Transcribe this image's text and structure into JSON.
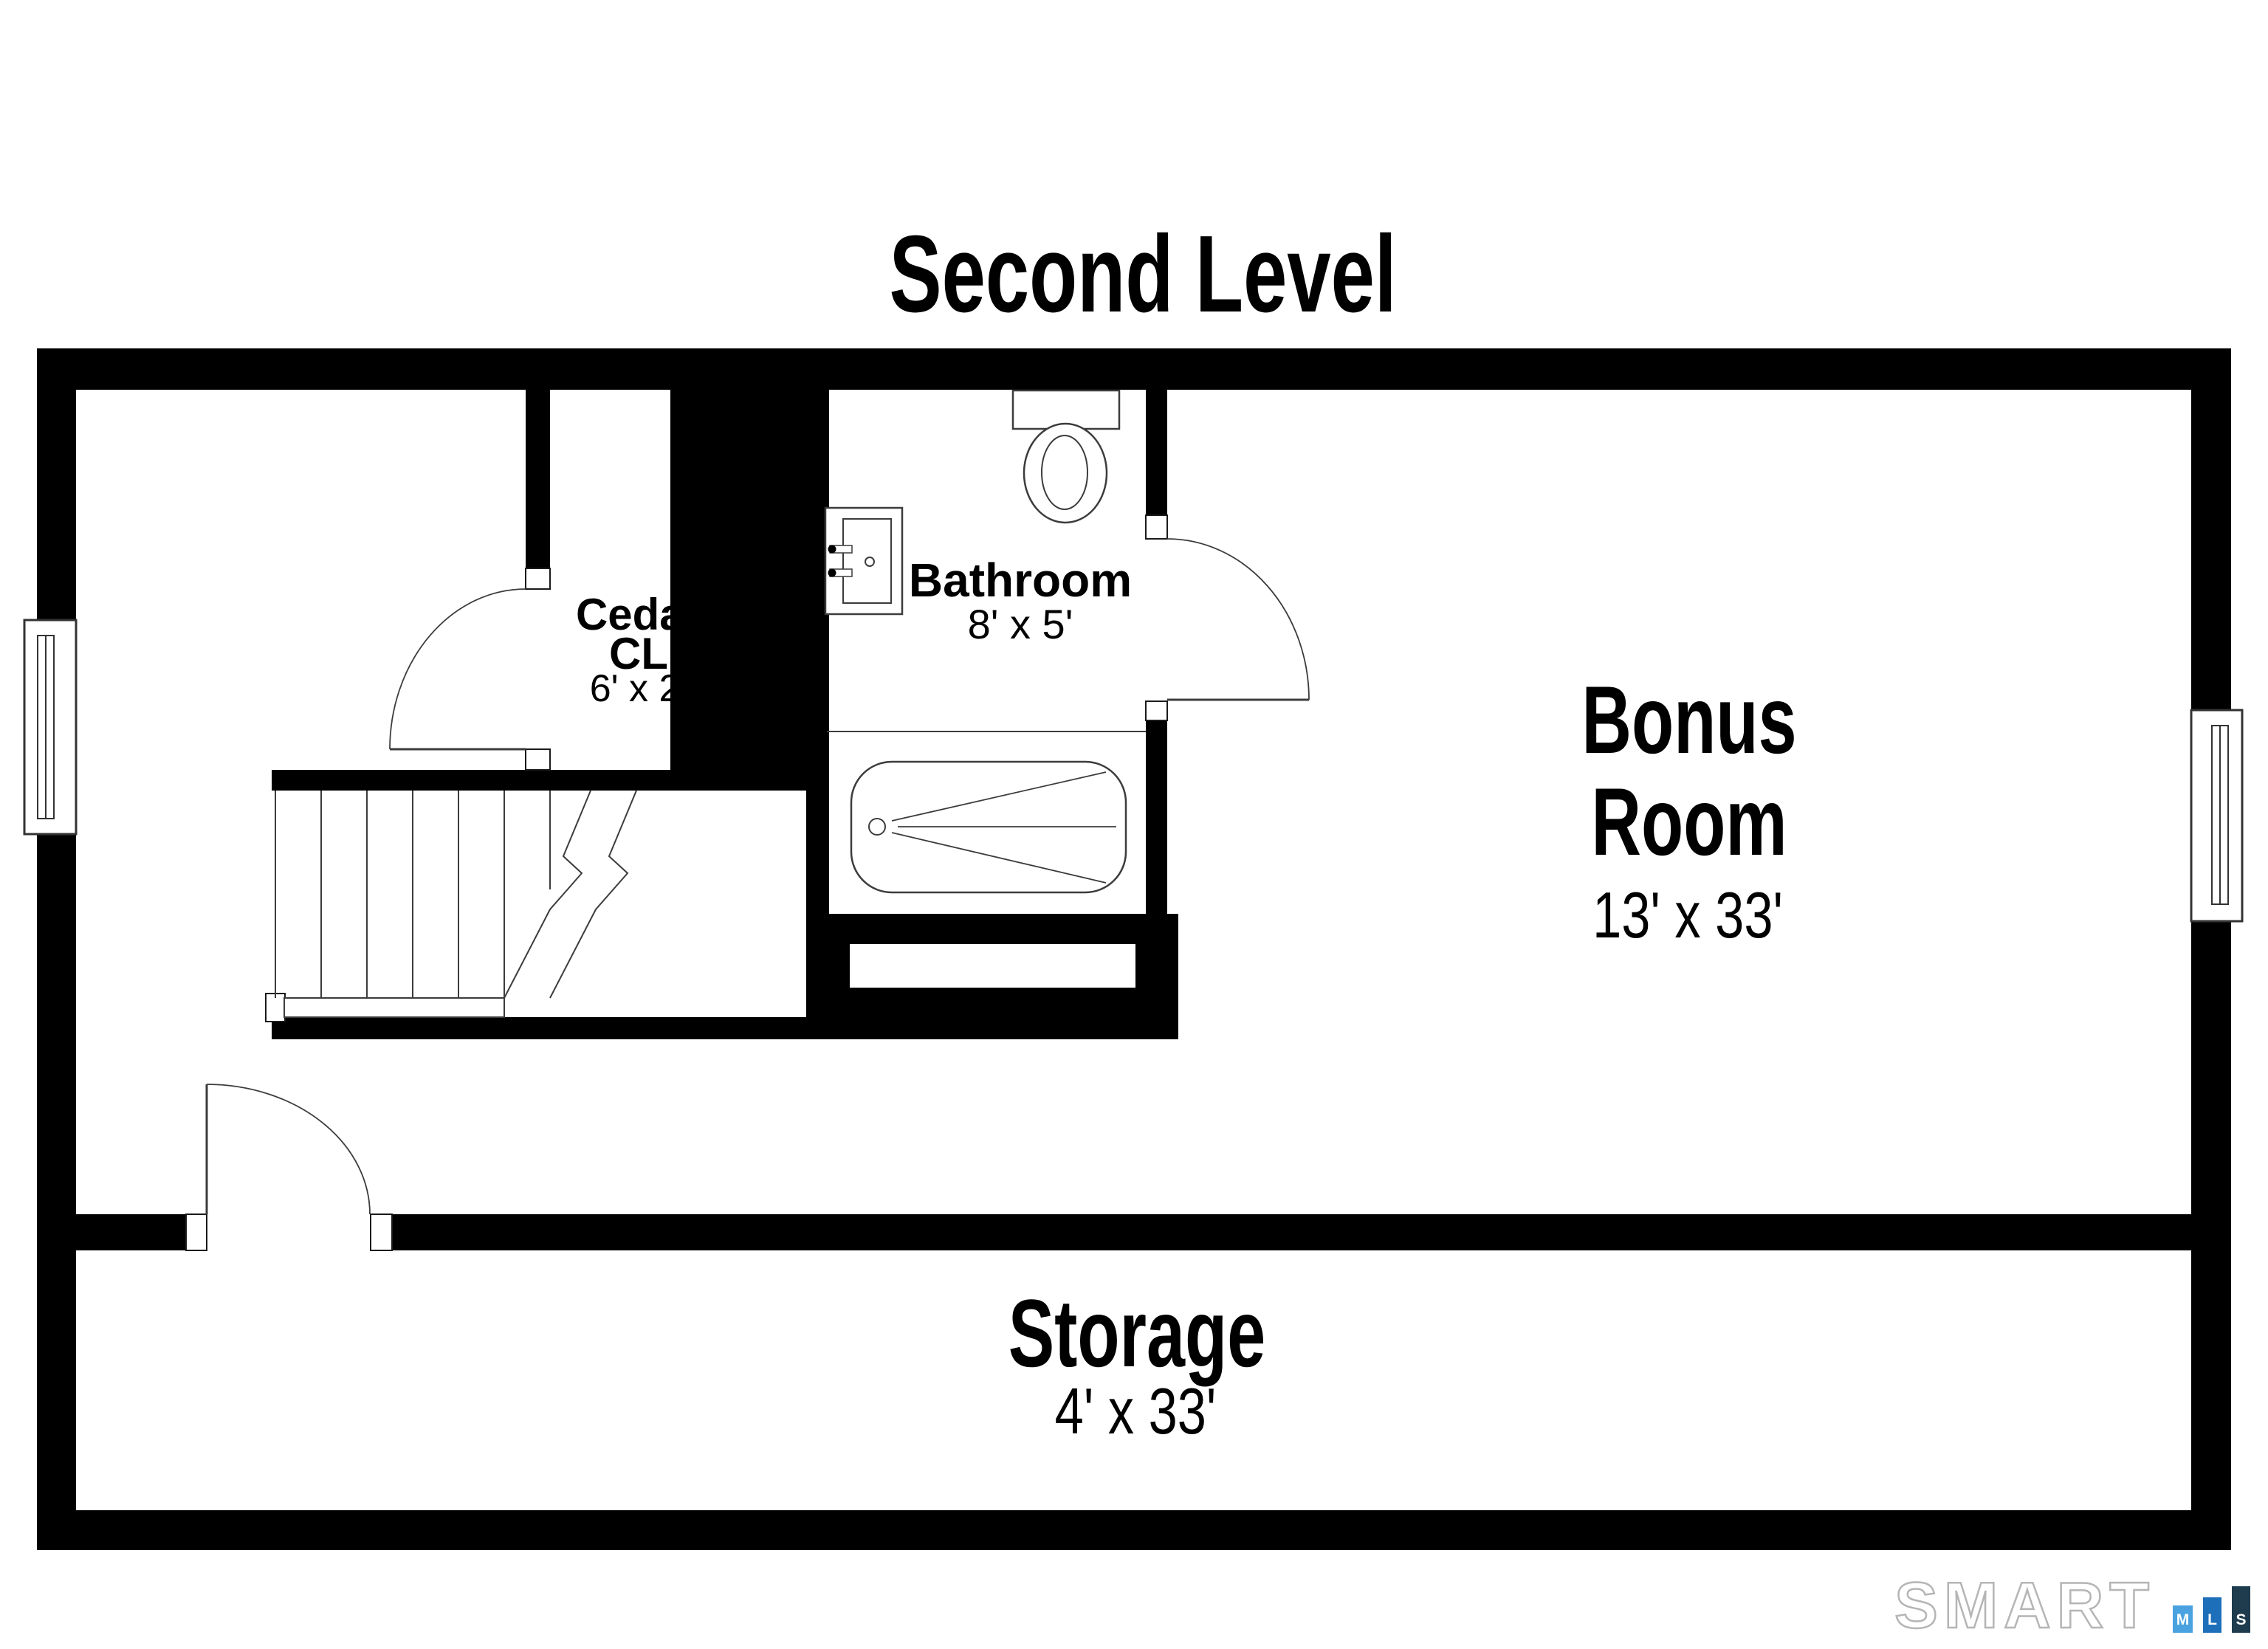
{
  "title": "Second Level",
  "rooms": [
    {
      "id": "cedar-closet",
      "lines": [
        "Cedar",
        "CL"
      ],
      "dims": "6' x 2'"
    },
    {
      "id": "bathroom",
      "lines": [
        "Bathroom"
      ],
      "dims": "8' x 5'"
    },
    {
      "id": "bonus-room",
      "lines": [
        "Bonus",
        "Room"
      ],
      "dims": "13' x 33'"
    },
    {
      "id": "storage",
      "lines": [
        "Storage"
      ],
      "dims": "4' x 33'"
    }
  ],
  "logo": {
    "brand": "SMART",
    "bar_m": "M",
    "bar_l": "L",
    "bar_s": "S",
    "color_m": "#4aa3e0",
    "color_l": "#1d6fba",
    "color_s": "#1e3c4e",
    "outline_color": "#b5b5b5"
  },
  "colors": {
    "wall": "#000000",
    "line": "#3c3c3c",
    "background": "#ffffff"
  }
}
